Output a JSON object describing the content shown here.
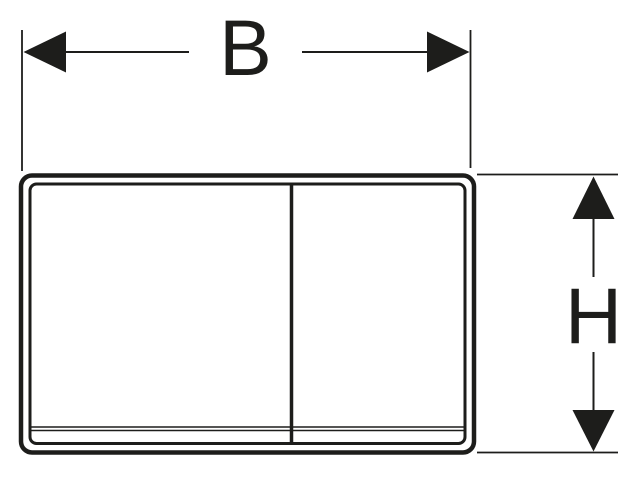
{
  "colors": {
    "line": "#1d1d1b",
    "background": "#ffffff"
  },
  "drawing": {
    "width_dimension": {
      "label": "B"
    },
    "height_dimension": {
      "label": "H"
    }
  }
}
